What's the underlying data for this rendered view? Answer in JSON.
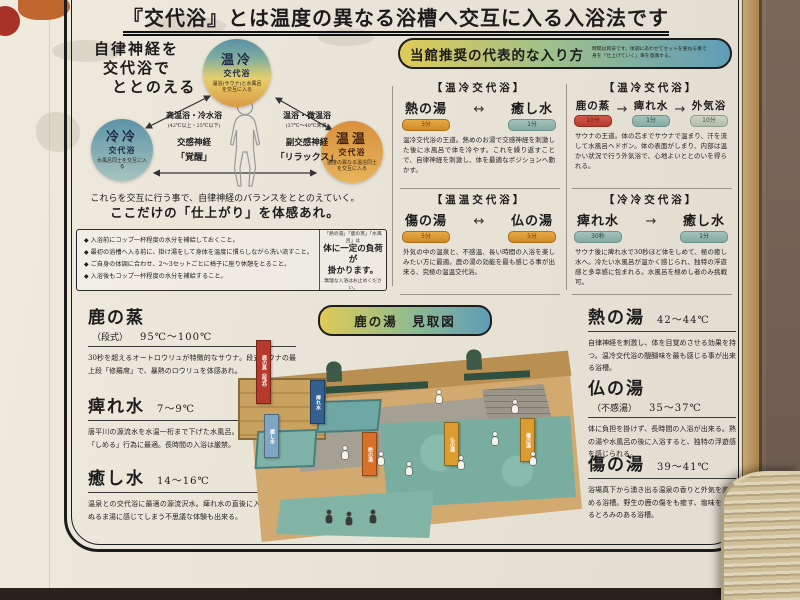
{
  "poster": {
    "title": "『交代浴』とは温度の異なる浴槽へ交互に入る入浴法です"
  },
  "intro": {
    "bullet_char": "◆",
    "heading_lines": [
      "自律神経を",
      "交代浴で",
      "ととのえる"
    ],
    "circles": [
      {
        "name": "温冷",
        "sub": "交代浴",
        "note": "温浴(サウナ)と水風呂を交互に入る"
      },
      {
        "name": "冷冷",
        "sub": "交代浴",
        "note": "水風呂同士を交互に入る"
      },
      {
        "name": "温温",
        "sub": "交代浴",
        "note": "温度の異なる温浴同士を交互に入る"
      }
    ],
    "left_label": {
      "line1": "高温浴・冷水浴",
      "line2": "(42℃以上・25℃以下)",
      "line3": "交感神経",
      "line4": "「覚醒」"
    },
    "right_label": {
      "line1": "温浴・微温浴",
      "line2": "(37℃〜40℃未満)",
      "line3": "副交感神経",
      "line4": "「リラックス」"
    },
    "summary1": "これらを交互に行う事で、自律神経のバランスをととのえていく。",
    "summary2": "ここだけの「仕上がり」を体感あれ。",
    "cautions": [
      "入浴前にコップ一杯程度の水分を補給しておくこと。",
      "最初の浴槽へ入る前に、掛け湯をして身体を温度に慣らしながら洗い流すこと。",
      "ご自身の体調に合わせ、2〜3セットごとに椅子に座り休憩をとること。",
      "入浴後もコップ一杯程度の水分を補給すること。"
    ],
    "caution_side": {
      "small_top": "「熱の湯」「鹿の蒸」「水風呂」は",
      "strong1": "体に一定の負荷が",
      "strong2": "掛かります。",
      "small_bottom": "無理な入浴はお止めください。"
    }
  },
  "methods": {
    "header": "当館推奨の代表的な入り方",
    "header_note1": "時間は目安です。体調にあわせてセットを重ねる事で",
    "header_note2": "身を「仕上げていく」事を意識する。",
    "items": [
      {
        "category": "【温冷交代浴】",
        "arrow": "↔",
        "steps": [
          {
            "name": "熱の湯",
            "time": "3分",
            "tone": "orange"
          },
          {
            "name": "癒し水",
            "time": "1分",
            "tone": "teal"
          }
        ],
        "desc": "温冷交代浴の王道。熱めのお湯で交感神経を刺激した後に水風呂で体を冷やす。これを繰り返すことで、自律神経を刺激し、体を最適なポジションへ動かす。"
      },
      {
        "category": "【温冷交代浴】",
        "arrow": "→",
        "steps": [
          {
            "name": "鹿の蒸",
            "time": "10分",
            "tone": "red"
          },
          {
            "name": "痺れ水",
            "time": "1分",
            "tone": "teal"
          },
          {
            "name": "外気浴",
            "time": "10分",
            "tone": "grey"
          }
        ],
        "desc": "サウナの王道。体の芯までサウナで温まり、汗を流して水風呂へドボン。体の表面がしまり、内部は温かい状況で行う外気浴で、心地よいととのいを得られる。"
      },
      {
        "category": "【温温交代浴】",
        "arrow": "↔",
        "steps": [
          {
            "name": "傷の湯",
            "time": "5分",
            "tone": "orange"
          },
          {
            "name": "仏の湯",
            "time": "5分",
            "tone": "orange"
          }
        ],
        "desc": "外気の中の温泉と、不感温、長い時間の入浴を楽しみたい方に最適。鹿の湯の効能を最も感じる事が出来る、究極の温温交代浴。"
      },
      {
        "category": "【冷冷交代浴】",
        "arrow": "→",
        "steps": [
          {
            "name": "痺れ水",
            "time": "30秒",
            "tone": "teal"
          },
          {
            "name": "癒し水",
            "time": "1分",
            "tone": "teal"
          }
        ],
        "desc": "サウナ後に痺れ水で30秒ほど体をしめて、極の癒し水へ。冷たい水風呂が温かく感じられ、独特の浮遊感と多幸感に包まれる。水風呂を極めし者のみ挑戦可。"
      }
    ]
  },
  "map": {
    "title": "鹿の湯　見取図",
    "banners": [
      {
        "label": "鹿の蒸（段式）"
      },
      {
        "label": "痺れ水"
      },
      {
        "label": "癒し水"
      },
      {
        "label": "熱の湯"
      },
      {
        "label": "仏の湯"
      },
      {
        "label": "傷の湯"
      }
    ]
  },
  "baths_left": [
    {
      "name": "鹿の蒸",
      "sub": "（段式）",
      "temp": "95℃〜100℃",
      "desc": "30秒を超えるオートロウリュが特徴的なサウナ。段式サウナの最上段「修羅席」で、暴熱のロウリュを体感あれ。"
    },
    {
      "name": "痺れ水",
      "temp": "7〜9℃",
      "desc": "唐平川の源流水を水温一桁まで下げた水風呂。サウナ後に表面を「しめる」行為に最適。長時間の入浴は厳禁。"
    },
    {
      "name": "癒し水",
      "temp": "14〜16℃",
      "desc": "温泉との交代浴に最適の源流沢水。痺れ水の直後に入浴すると、ぬるま湯に感じてしまう不思議な体験も出来る。"
    }
  ],
  "baths_right": [
    {
      "name": "熱の湯",
      "temp": "42〜44℃",
      "desc": "自律神経を刺激し、体を目覚めさせる効果を持つ。温冷交代浴の醍醐味を最も感じる事が出来る浴槽。"
    },
    {
      "name": "仏の湯",
      "sub": "（不感湯）",
      "temp": "35〜37℃",
      "desc": "体に負担を掛けず、長時間の入浴が出来る。熱の湯や水風呂の後に入浴すると、独特の浮遊感を感じられる。"
    },
    {
      "name": "傷の湯",
      "temp": "39〜41℃",
      "desc": "浴場真下から湧き出る温泉の香りと外気を楽しめる浴槽。野生の鹿の傷をも癒す、塩味を感じるとろみのある浴槽。"
    }
  ],
  "colors": {
    "paper": "#e9e4d8",
    "frame": "#1c1c1c",
    "wood_wall": "#7b675a",
    "badge_orange": "#d08a25",
    "badge_red": "#b73c30",
    "badge_teal": "#86aaa3",
    "badge_grey": "#b3bcab",
    "pill_yellow": "#dfca58",
    "pill_blue": "#5f9cb8",
    "pool_teal": "#78ad9f",
    "banner_red": "#b7392c",
    "banner_blue": "#33608f",
    "banner_orange": "#d8702a",
    "banner_yellow": "#dd9c2f"
  }
}
